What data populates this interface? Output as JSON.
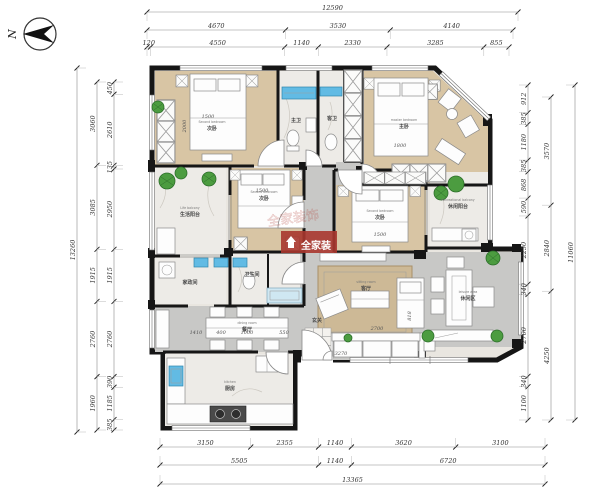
{
  "north": {
    "label": "N"
  },
  "watermark": {
    "text": "全家装",
    "faint": "全家装饰"
  },
  "rooms": [
    {
      "en": "Second bedroom",
      "cn": "次卧"
    },
    {
      "en": "master bedroom",
      "cn": "主卧"
    },
    {
      "en": "Second bedroom",
      "cn": "次卧"
    },
    {
      "en": "Second bedroom",
      "cn": "次卧"
    },
    {
      "en": "Life balcony",
      "cn": "生活阳台"
    },
    {
      "en": "Recreational balcony",
      "cn": "休闲阳台"
    },
    {
      "en": "sitting room",
      "cn": "客厅"
    },
    {
      "en": "dining room",
      "cn": "餐厅"
    },
    {
      "en": "kitchen",
      "cn": "厨房"
    },
    {
      "en": "leisure area",
      "cn": "休闲区"
    },
    {
      "en": "bath",
      "cn": "主卫"
    },
    {
      "en": "bath",
      "cn": "客卫"
    },
    {
      "en": "porch",
      "cn": "玄关"
    },
    {
      "en": "bath",
      "cn": "卫生间"
    },
    {
      "en": "laundry",
      "cn": "家政间"
    }
  ],
  "inner_dims": [
    {
      "t": "1500",
      "x": 208,
      "y": 118,
      "r": 0
    },
    {
      "t": "2000",
      "x": 186,
      "y": 126,
      "r": -90
    },
    {
      "t": "1800",
      "x": 400,
      "y": 147,
      "r": 0
    },
    {
      "t": "1500",
      "x": 262,
      "y": 192,
      "r": 0
    },
    {
      "t": "1500",
      "x": 380,
      "y": 236,
      "r": 0
    },
    {
      "t": "1410",
      "x": 196,
      "y": 334,
      "r": 0
    },
    {
      "t": "400",
      "x": 221,
      "y": 334,
      "r": 0
    },
    {
      "t": "1000",
      "x": 247,
      "y": 334,
      "r": 0
    },
    {
      "t": "550",
      "x": 284,
      "y": 334,
      "r": 0
    },
    {
      "t": "2700",
      "x": 377,
      "y": 330,
      "r": 0
    },
    {
      "t": "3270",
      "x": 341,
      "y": 355,
      "r": 0
    },
    {
      "t": "818",
      "x": 411,
      "y": 316,
      "r": -90
    }
  ],
  "dimension_chains": [
    {
      "o": "h",
      "pos": 12,
      "from": 147,
      "to": 518,
      "stub": 1,
      "values": [
        "12590"
      ]
    },
    {
      "o": "h",
      "pos": 30,
      "from": 147,
      "to": 513,
      "stub": 1,
      "values": [
        "4670",
        "3530",
        "4140"
      ]
    },
    {
      "o": "h",
      "pos": 47,
      "from": 147,
      "to": 509,
      "stub": 1,
      "values": [
        "120",
        "4550",
        "1140",
        "2330",
        "3285",
        "855"
      ]
    },
    {
      "o": "h",
      "pos": 447,
      "from": 160,
      "to": 545,
      "stub": -1,
      "values": [
        "3150",
        "2355",
        "1140",
        "3620",
        "3100"
      ]
    },
    {
      "o": "h",
      "pos": 465,
      "from": 160,
      "to": 545,
      "stub": -1,
      "values": [
        "5505",
        "1140",
        "6720"
      ]
    },
    {
      "o": "h",
      "pos": 484,
      "from": 160,
      "to": 545,
      "stub": -1,
      "values": [
        "13365"
      ]
    },
    {
      "o": "v",
      "pos": 77,
      "from": 68,
      "to": 432,
      "stub": 1,
      "values": [
        "13260"
      ]
    },
    {
      "o": "v",
      "pos": 97,
      "from": 82,
      "to": 430,
      "stub": 1,
      "values": [
        "3060",
        "3085",
        "1915",
        "2760",
        "1960"
      ]
    },
    {
      "o": "v",
      "pos": 114,
      "from": 82,
      "to": 430,
      "stub": 1,
      "values": [
        "450",
        "2610",
        "135",
        "2950",
        "1915",
        "2760",
        "390",
        "1185",
        "385"
      ]
    },
    {
      "o": "v",
      "pos": 528,
      "from": 85,
      "to": 420,
      "stub": -1,
      "values": [
        "912",
        "385",
        "1180",
        "385",
        "868",
        "590",
        "2250",
        "340",
        "2700",
        "340",
        "1100"
      ]
    },
    {
      "o": "v",
      "pos": 551,
      "from": 97,
      "to": 420,
      "stub": -1,
      "values": [
        "3570",
        "2840",
        "4250"
      ]
    },
    {
      "o": "v",
      "pos": 575,
      "from": 85,
      "to": 420,
      "stub": -1,
      "values": [
        "11060"
      ]
    }
  ]
}
